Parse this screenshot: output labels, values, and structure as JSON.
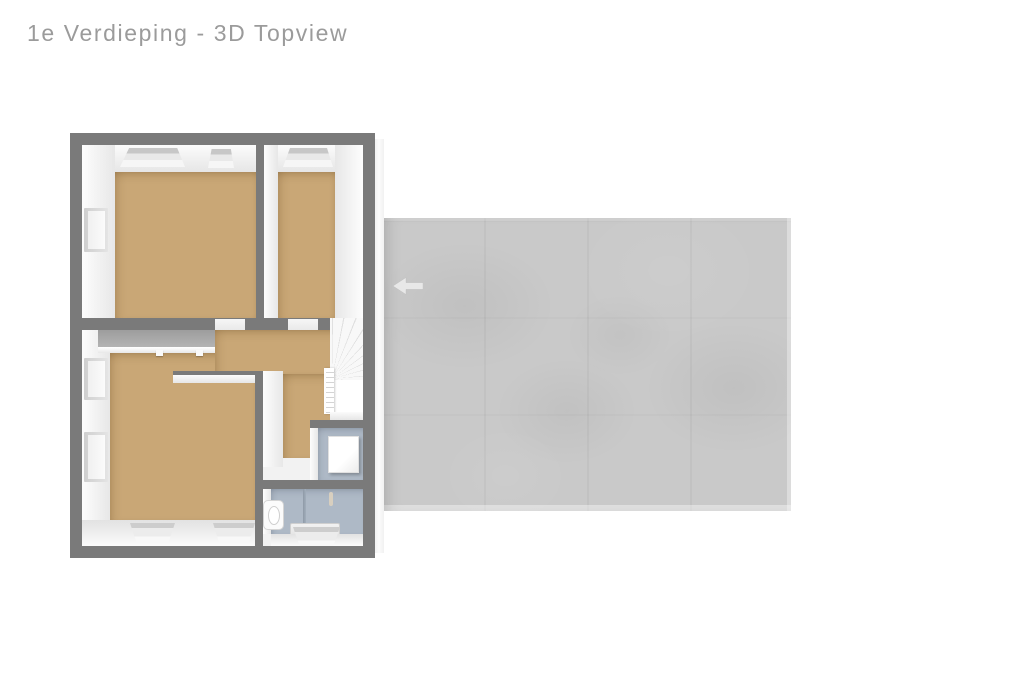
{
  "page": {
    "title": "1e Verdieping - 3D Topview"
  },
  "colors": {
    "title": "#9b9b9b",
    "wall": "#7a7a7a",
    "floor_wood": "#c9a776",
    "floor_bath": "#aeb9c6",
    "roof": "#c9c9c9",
    "interior": "#f2f2f2",
    "arrow": "#e8e8e8"
  },
  "roof": {
    "arrow_icon": "arrow-left"
  }
}
